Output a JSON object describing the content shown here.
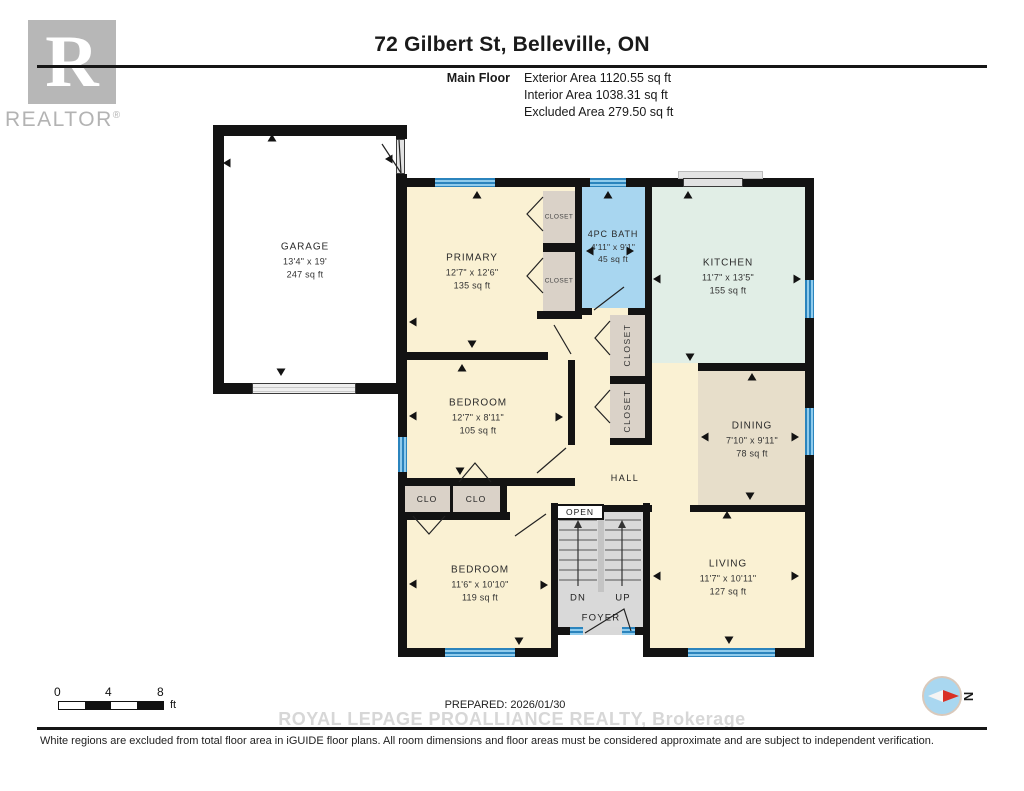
{
  "header": {
    "title": "72 Gilbert St, Belleville, ON",
    "floor_label": "Main Floor",
    "exterior": "Exterior Area 1120.55 sq ft",
    "interior": "Interior Area 1038.31 sq ft",
    "excluded": "Excluded Area 279.50 sq ft"
  },
  "logo": {
    "letter": "R",
    "brand": "REALTOR",
    "reg": "®"
  },
  "rooms": {
    "garage": {
      "name": "GARAGE",
      "dims": "13'4\" x 19'",
      "area": "247 sq ft"
    },
    "primary": {
      "name": "PRIMARY",
      "dims": "12'7\" x 12'6\"",
      "area": "135 sq ft"
    },
    "bath": {
      "name": "4PC BATH",
      "dims": "4'11\" x 9'1\"",
      "area": "45 sq ft"
    },
    "kitchen": {
      "name": "KITCHEN",
      "dims": "11'7\" x 13'5\"",
      "area": "155 sq ft"
    },
    "dining": {
      "name": "DINING",
      "dims": "7'10\" x 9'11\"",
      "area": "78 sq ft"
    },
    "bedroom_mid": {
      "name": "BEDROOM",
      "dims": "12'7\" x 8'11\"",
      "area": "105 sq ft"
    },
    "bedroom_lower": {
      "name": "BEDROOM",
      "dims": "11'6\" x 10'10\"",
      "area": "119 sq ft"
    },
    "living": {
      "name": "LIVING",
      "dims": "11'7\" x 10'11\"",
      "area": "127 sq ft"
    },
    "hall": {
      "name": "HALL"
    }
  },
  "labels": {
    "closet": "CLOSET",
    "clo": "CLO",
    "open": "OPEN",
    "dn": "DN",
    "up": "UP",
    "foyer": "FOYER"
  },
  "scale_bar": {
    "tick0": "0",
    "tick4": "4",
    "tick8": "8",
    "unit": "ft"
  },
  "compass": {
    "north": "N"
  },
  "footer": {
    "prepared": "PREPARED: 2026/01/30",
    "watermark": "ROYAL LEPAGE PROALLIANCE REALTY, Brokerage",
    "disclaimer": "White regions are excluded from total floor area in iGUIDE floor plans. All room dimensions and floor areas must be considered approximate and are subject to independent verification."
  },
  "colors": {
    "wall": "#131313",
    "room_cream": "#faf1d3",
    "bath_blue": "#a8d6f0",
    "kitchen_mint": "#e1eee6",
    "dining_tan": "#e7deca",
    "closet_tan": "#dad2c8",
    "stairs_gray": "#d9d9d9",
    "window_blue": "#3e9cd3"
  }
}
